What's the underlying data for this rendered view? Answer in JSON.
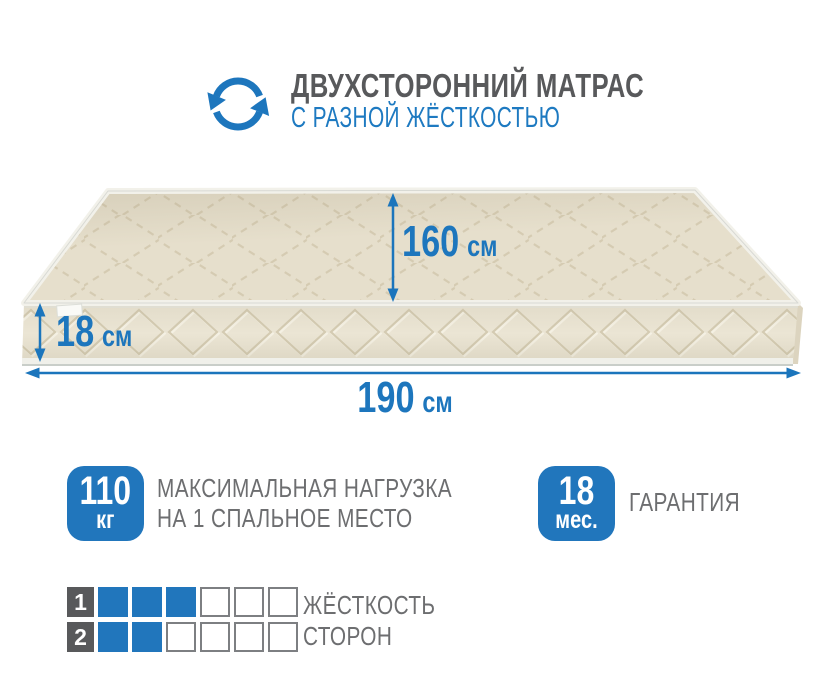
{
  "colors": {
    "accent_blue": "#1d76bd",
    "subtitle_blue": "#1e7ac1",
    "title_gray": "#58595b",
    "text_gray": "#6d6e70",
    "badge_blue": "#2176bc",
    "square_blue": "#2176bc",
    "square_border_gray": "#7d7f82",
    "mattress_top": "#e6dfcc",
    "mattress_front": "#ebe5d4",
    "quilt_line": "#d2c8ae",
    "piping_white": "#f2f1ea"
  },
  "header": {
    "icon": "rotate-sync-icon",
    "title": "ДВУХСТОРОННИЙ МАТРАС",
    "subtitle": "С РАЗНОЙ ЖЁСТКОСТЬЮ"
  },
  "mattress": {
    "dimensions": {
      "width": {
        "value": "160",
        "unit": "см"
      },
      "height": {
        "value": "18",
        "unit": "см"
      },
      "length": {
        "value": "190",
        "unit": "см"
      }
    }
  },
  "features": {
    "max_load": {
      "badge_value": "110",
      "badge_unit": "кг",
      "line1": "МАКСИМАЛЬНАЯ НАГРУЗКА",
      "line2": "НА 1 СПАЛЬНОЕ МЕСТО"
    },
    "warranty": {
      "badge_value": "18",
      "badge_unit": "мес.",
      "line1": "ГАРАНТИЯ"
    }
  },
  "firmness": {
    "line1": "ЖЁСТКОСТЬ",
    "line2": "СТОРОН",
    "scale_max": 6,
    "rows": [
      {
        "label": "1",
        "filled": 3,
        "total": 6
      },
      {
        "label": "2",
        "filled": 2,
        "total": 6
      }
    ]
  }
}
